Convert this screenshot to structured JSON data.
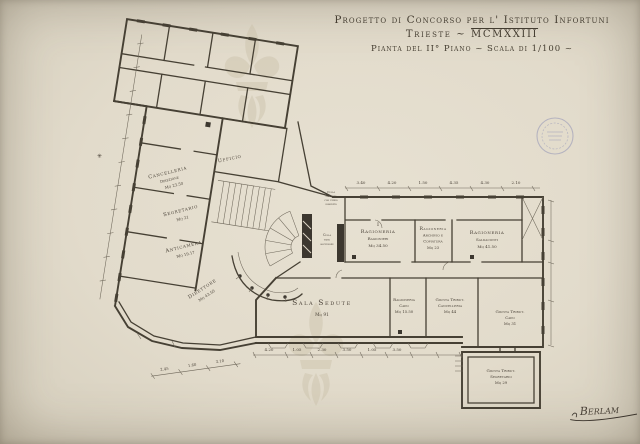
{
  "title": {
    "line1": "Progetto di Concorso per l' Istituto Infortuni",
    "line2_prefix": "Trieste ~",
    "line2_roman": "MCMXXIII",
    "line3": "Pianta del II° Piano ~ Scala di 1/100 ~"
  },
  "rooms": {
    "cancelleria": {
      "name": "Cancelleria",
      "sub": "Direzione",
      "area": "Mq 23.50"
    },
    "segretario": {
      "name": "Segretario",
      "area": "Mq 21"
    },
    "anticamera": {
      "name": "Anticamera",
      "area": "Mq 19.17"
    },
    "ufficio": {
      "name": "Ufficio"
    },
    "direttore": {
      "name": "Direttore",
      "area": "Mq 43.50"
    },
    "rag_ragionieri": {
      "num": "I",
      "name": "Ragioneria",
      "sub": "Ragionieri",
      "area": "Mq 34.50"
    },
    "rag_archivio": {
      "name": "Ragioneria",
      "sub": "Archivio e",
      "sub2": "Copiatura",
      "area": "Mq 23"
    },
    "rag_saldaconti": {
      "name": "Ragioneria",
      "sub": "Saldaconti",
      "area": "Mq 41.50"
    },
    "sala_sedute": {
      "name": "Sala Sedute",
      "area": "Mq 91"
    },
    "rag_capo": {
      "name": "Ragioneria",
      "sub": "Capo",
      "area": "Mq 15.50"
    },
    "giunta_cancelleria": {
      "name": "Giunta Tribut.",
      "sub": "Cancelleria",
      "area": "Mq 44"
    },
    "giunta_capo": {
      "name": "Giunta Tribut.",
      "sub": "Capo",
      "area": "Mq 31"
    },
    "giunta_segretario": {
      "name": "Giunta Tribut.",
      "sub": "Segretario",
      "area": "Mq 29"
    },
    "cella_ascensore": {
      "l1": "Cella",
      "l2": "vano",
      "l3": "ascensore"
    },
    "cella_note": {
      "l1": "Cella",
      "l2": "soffitto",
      "l3": "con ferro",
      "l4": "smaltato"
    }
  },
  "dims": {
    "top": [
      "3.40",
      "4.20",
      "1.50",
      "4.35",
      "4.30",
      "2.10"
    ],
    "bottom": [
      "4.20",
      "1.05",
      "2.30",
      "3.50",
      "1.05",
      "3.50"
    ],
    "bottom_left": [
      "2.45",
      "1.60",
      "3.10"
    ]
  },
  "marks": {
    "asterisk": "✳"
  },
  "signature": "Berlam",
  "colors": {
    "ink": "#464034",
    "paper": "#e2dbcb",
    "stamp": "#7e82b0",
    "watermark": "#c9bfa8"
  }
}
